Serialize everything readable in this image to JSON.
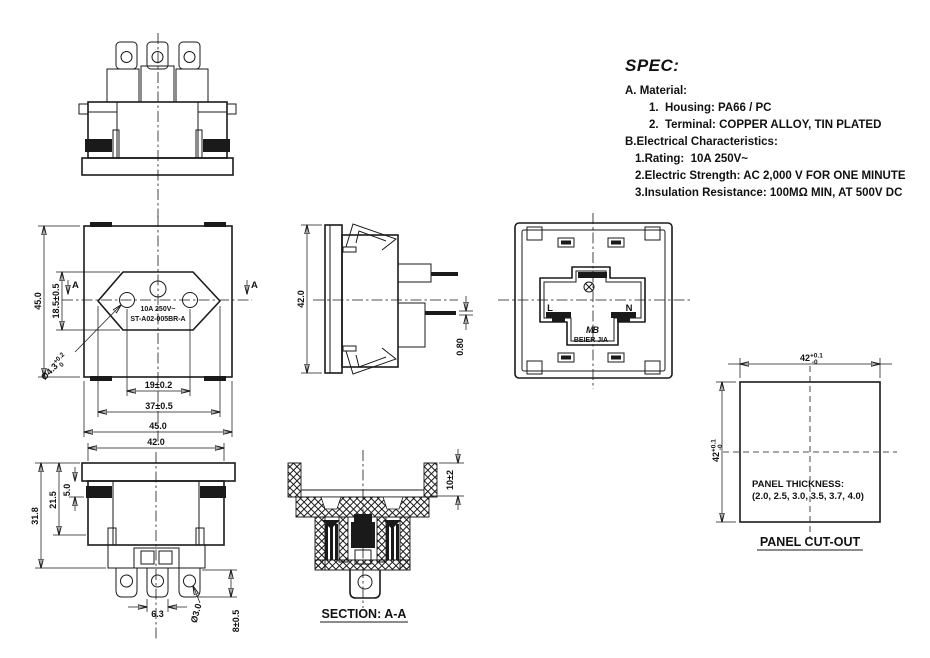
{
  "spec": {
    "title": "SPEC:",
    "items": [
      "A. Material:",
      "1.  Housing: PA66 / PC",
      "2.  Terminal: COPPER ALLOY, TIN PLATED",
      "B.Electrical Characteristics:",
      "1.Rating:  10A 250V~",
      "2.Electric Strength: AC 2,000 V FOR ONE MINUTE",
      "3.Insulation Resistance: 100MΩ MIN, AT 500V DC"
    ]
  },
  "front_view": {
    "marking_line1": "10A 250V~",
    "marking_line2": "ST-A02-005BR-A",
    "dim_height": "45.0",
    "dim_recess_height": "18.5±0.5",
    "dim_pin_spacing": "19±0.2",
    "dim_recess_width": "37±0.5",
    "dim_width": "45.0",
    "hole_dia": "Ø4.3",
    "hole_dia_tol_plus": "+0.2",
    "hole_dia_tol_minus": "0",
    "section_mark_left": "A",
    "section_mark_right": "A"
  },
  "side_view": {
    "dim_height": "42.0",
    "dim_pin_thickness": "0.80"
  },
  "back_view": {
    "label_line": "L",
    "label_neutral": "N",
    "logo": "MB",
    "brand": "BEIER JIA"
  },
  "bottom_view": {
    "dim_width": "42.0",
    "dim_total_depth": "31.8",
    "dim_body_depth": "21.5",
    "dim_clip_depth": "5.0",
    "dim_terminal_width": "6.3",
    "hole_dia": "Ø3.0",
    "dim_terminal_length": "8±0.5"
  },
  "section_view": {
    "dim_face_depth": "10±2",
    "title": "SECTION: A-A"
  },
  "panel_cutout": {
    "dim_width": "42",
    "dim_width_tol_plus": "+0.1",
    "dim_width_tol_minus": "-0",
    "dim_height": "42",
    "dim_height_tol_plus": "+0.1",
    "dim_height_tol_minus": "-0",
    "note_line1": "PANEL THICKNESS:",
    "note_line2": "(2.0, 2.5, 3.0, 3.5, 3.7, 4.0)",
    "title": "PANEL CUT-OUT"
  },
  "colors": {
    "line": "#1a1a1a",
    "background": "#ffffff"
  }
}
